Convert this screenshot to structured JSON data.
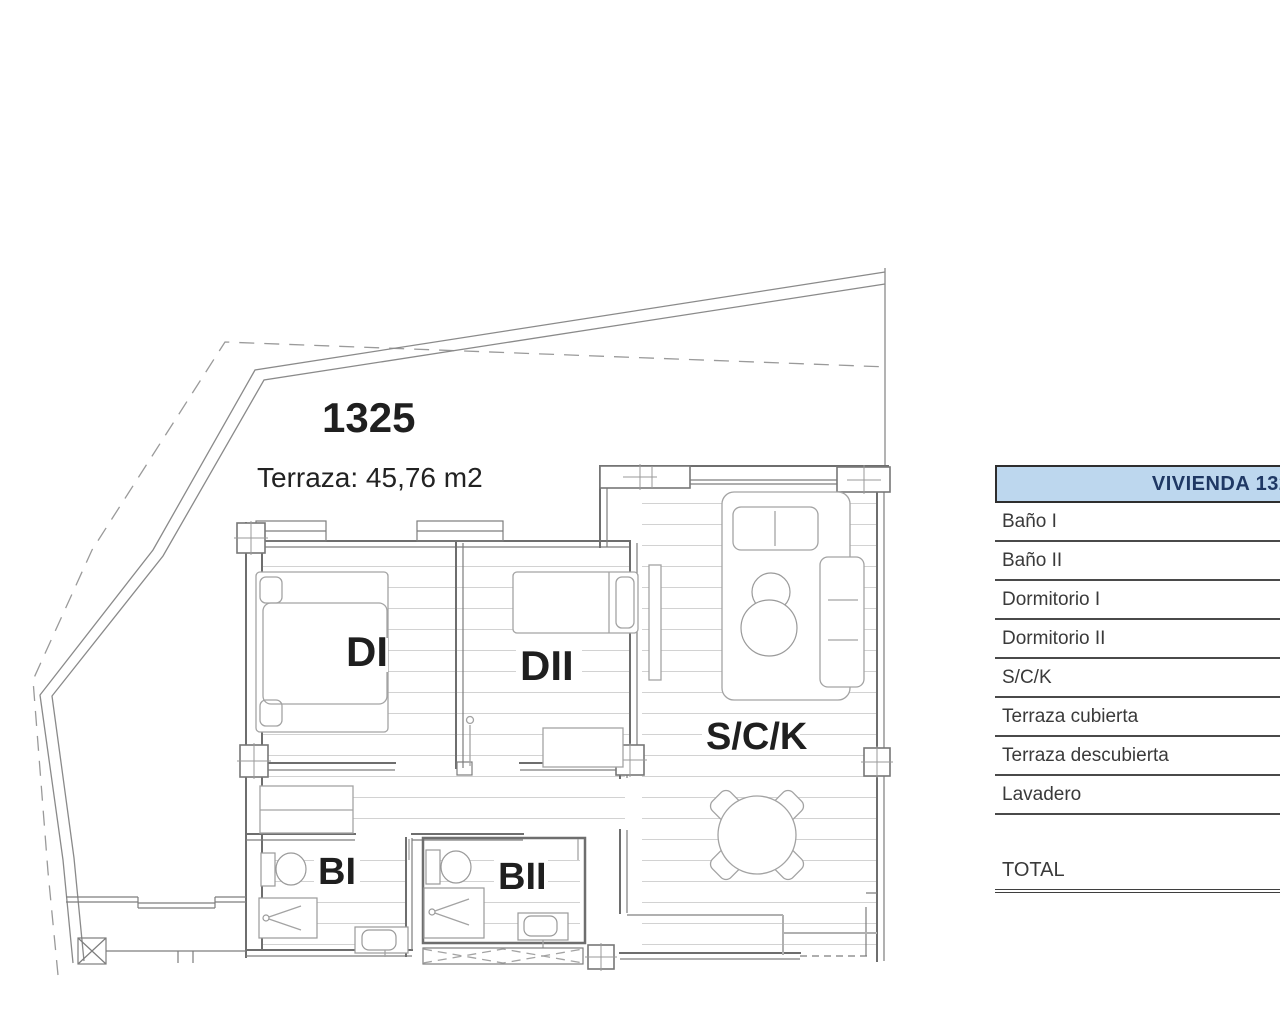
{
  "plan": {
    "unit_number": "1325",
    "terrace_label": "Terraza: 45,76 m2",
    "accent_red": "#c62b27",
    "rooms": {
      "dormitorio1": "DI",
      "dormitorio2": "DII",
      "salon": "S/C/K",
      "bano1": "BI",
      "bano2": "BII"
    }
  },
  "table": {
    "header": "VIVIENDA 1325",
    "header_fill": "#bdd7ee",
    "header_text_color": "#1f3864",
    "rows": [
      {
        "label": "Baño I"
      },
      {
        "label": "Baño II"
      },
      {
        "label": "Dormitorio I"
      },
      {
        "label": "Dormitorio II"
      },
      {
        "label": "S/C/K"
      },
      {
        "label": "Terraza cubierta"
      },
      {
        "label": "Terraza descubierta"
      },
      {
        "label": "Lavadero"
      }
    ],
    "total_label": "TOTAL"
  }
}
